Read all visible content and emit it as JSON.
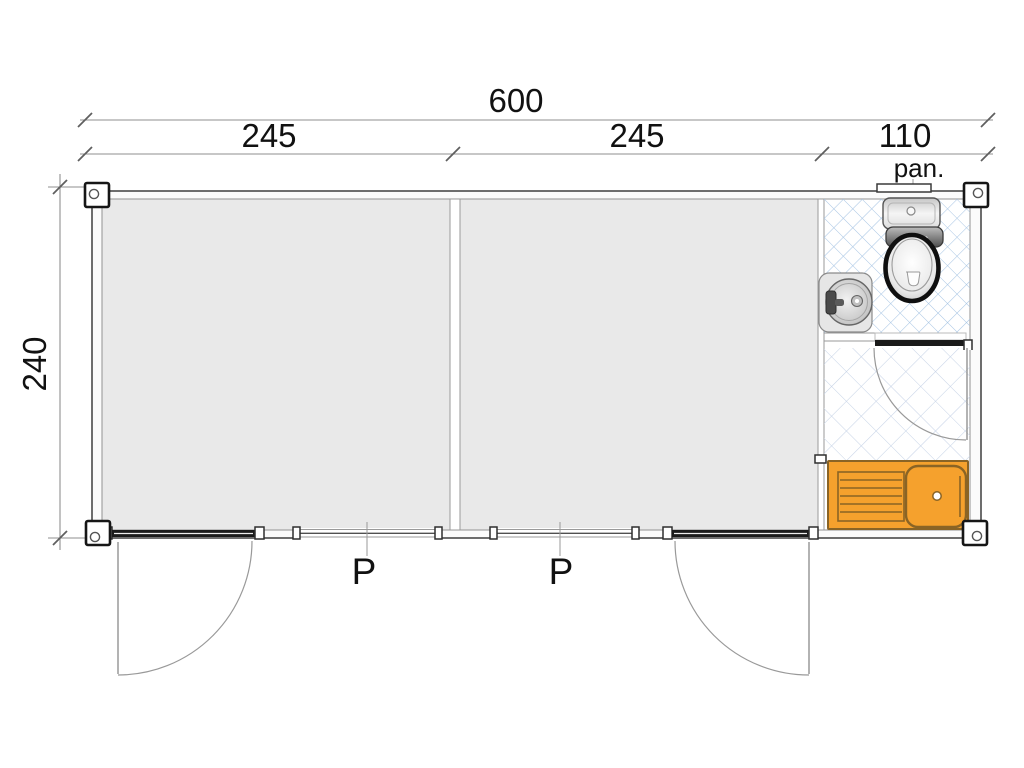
{
  "plan": {
    "dim_total": "600",
    "dim_segments": [
      "245",
      "245",
      "110"
    ],
    "dim_height": "240",
    "window_note": "pan.",
    "door_labels": [
      "P",
      "P"
    ]
  },
  "colors": {
    "floor": "#e9e9e9",
    "wall_outline": "#4a4a4a",
    "wall_inner": "#9a9a9a",
    "dim_line": "#8f8f8f",
    "tick": "#5f5f5f",
    "text": "#111111",
    "tile_line": "#a9c6e4",
    "tile_line_light": "#c6d3e6",
    "counter_orange": "#f5a12d",
    "counter_line": "#8a6425",
    "door_panel": "#1a1a1a",
    "swing_arc": "#999999"
  }
}
